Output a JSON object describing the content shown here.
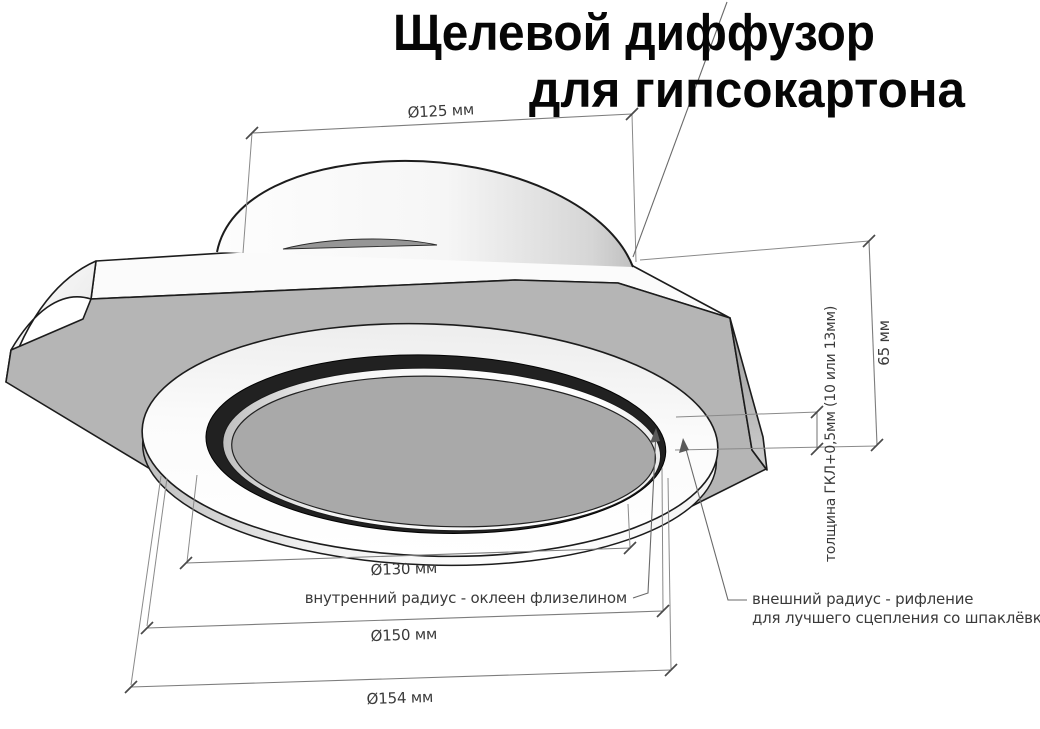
{
  "title": {
    "line1": "Щелевой диффузор",
    "line2": "для гипсокартона"
  },
  "dimensions": {
    "duct_diameter": "Ø125 мм",
    "height": "65 мм",
    "plate_thickness": "толщина ГКЛ+0,5мм (10 или 13мм)",
    "inner_diameter": "Ø130 мм",
    "outer_diameter": "Ø150 мм",
    "overall_diameter": "Ø154 мм"
  },
  "annotations": {
    "inner_radius": "внутренний радиус - оклеен флизелином",
    "outer_radius_line1": "внешний радиус - рифление",
    "outer_radius_line2": "для лучшего сцепления со шпаклёвкой"
  },
  "colors": {
    "background": "#ffffff",
    "panel_gray": "#b5b5b5",
    "disc_gray": "#a9a9a9",
    "slot_dark": "#212121",
    "dimension_line": "#7d7d7d",
    "annotation_text": "#3a3a3a",
    "title_text": "#060606"
  }
}
